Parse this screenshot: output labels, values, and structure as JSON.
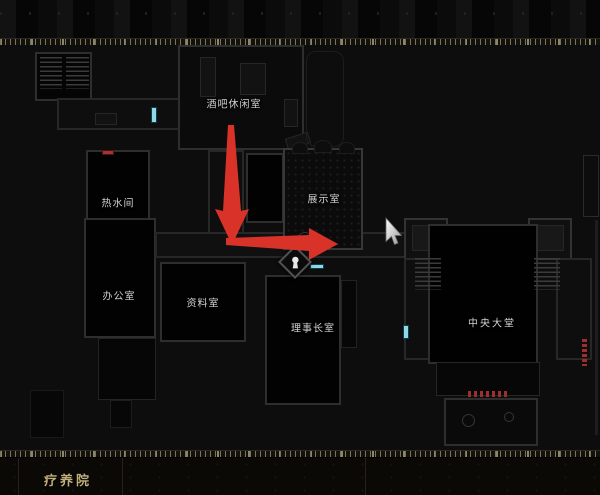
{
  "screen": {
    "name": "game-map-screen"
  },
  "map": {
    "rooms": [
      {
        "id": "bar-lounge",
        "label": "酒吧休闲室"
      },
      {
        "id": "hot-water-room",
        "label": "热水间"
      },
      {
        "id": "exhibition-room",
        "label": "展示室"
      },
      {
        "id": "office",
        "label": "办公室"
      },
      {
        "id": "archive-room",
        "label": "资料室"
      },
      {
        "id": "director-room",
        "label": "理事长室"
      },
      {
        "id": "central-hall",
        "label": "中央大堂"
      }
    ],
    "markers": {
      "keyhole": "locked-door-keyhole-icon",
      "cursor": "mouse-cursor-icon",
      "door_marker": "door-marker",
      "route_arrows": [
        "route-arrow-down",
        "route-arrow-right"
      ]
    },
    "colors": {
      "route_arrow": "#d93229",
      "door_cyan": "#8fd8e6",
      "marker_red": "#a33432",
      "room_outline": "#2e2e2e",
      "label_text": "#d2d2d2",
      "area_label_text": "#c2ae7d"
    }
  },
  "footer": {
    "area_label": "疗养院"
  }
}
